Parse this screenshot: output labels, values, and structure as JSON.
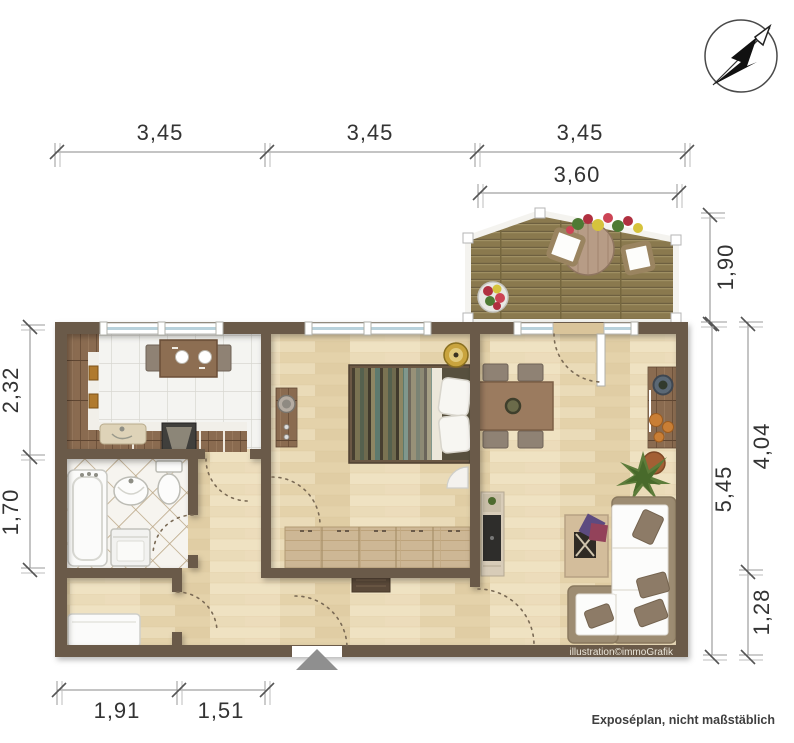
{
  "meta": {
    "footer": "Exposéplan, nicht maßstäblich",
    "credit": "illustration©immoGrafik"
  },
  "dims": {
    "top": [
      "3,45",
      "3,45",
      "3,45"
    ],
    "balcony_width": "3,60",
    "balcony_depth": "1,90",
    "left_kitchen": "2,32",
    "left_bath": "1,70",
    "right_total": "5,45",
    "right_upper": "4,04",
    "right_lower": "1,28",
    "bottom_left": "1,91",
    "bottom_right": "1,51"
  },
  "icons": {
    "compass": "north-arrow"
  },
  "colors": {
    "wall": "#6a5a49",
    "wood_floor": "#eadbb8",
    "kitchen_tile": "#f4f4f1",
    "bath_tile": "#f6f4ef",
    "balcony_deck": "#8a794e",
    "furniture_wood": "#8a6b50",
    "dim_text": "#333333",
    "window_glass": "#b9d2dc",
    "entrance_arrow": "#8f8f8f"
  }
}
